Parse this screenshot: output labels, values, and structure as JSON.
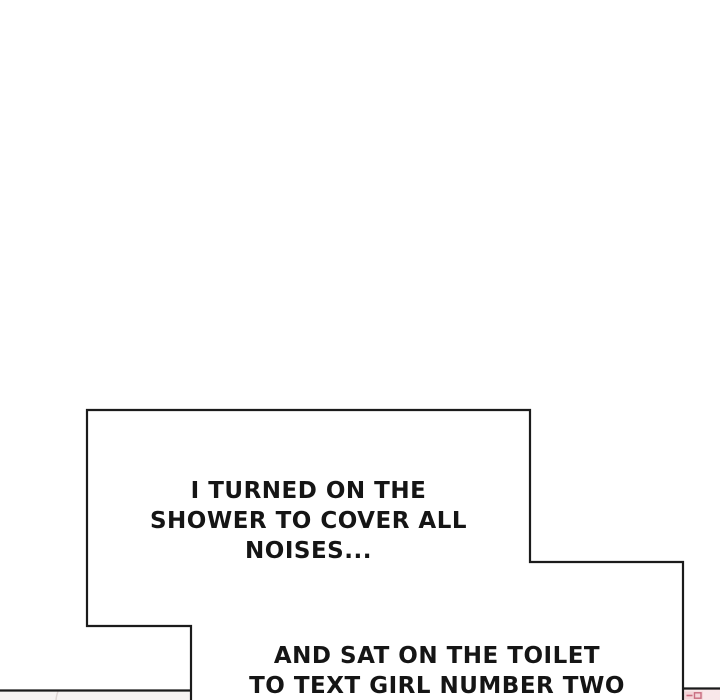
{
  "page": {
    "type": "webtoon-comic-panel",
    "background_color": "#ffffff",
    "ink_color": "#1b1b1b"
  },
  "speech_bubbles": [
    {
      "name": "shower-caption",
      "lines": [
        "I TURNED ON THE",
        "SHOWER TO COVER ALL",
        "NOISES..."
      ]
    },
    {
      "name": "toilet-caption",
      "lines": [
        "AND SAT ON THE TOILET",
        "TO TEXT GIRL NUMBER TWO"
      ]
    }
  ],
  "next_panel_fragment": {
    "left_area_tint": "#f6f3f2",
    "pink_wash": "#f9e7e9",
    "pink_fill": "#f2cbd1",
    "pink_accent": "#dd8f9e",
    "pink_stroke": "#c96d80"
  }
}
